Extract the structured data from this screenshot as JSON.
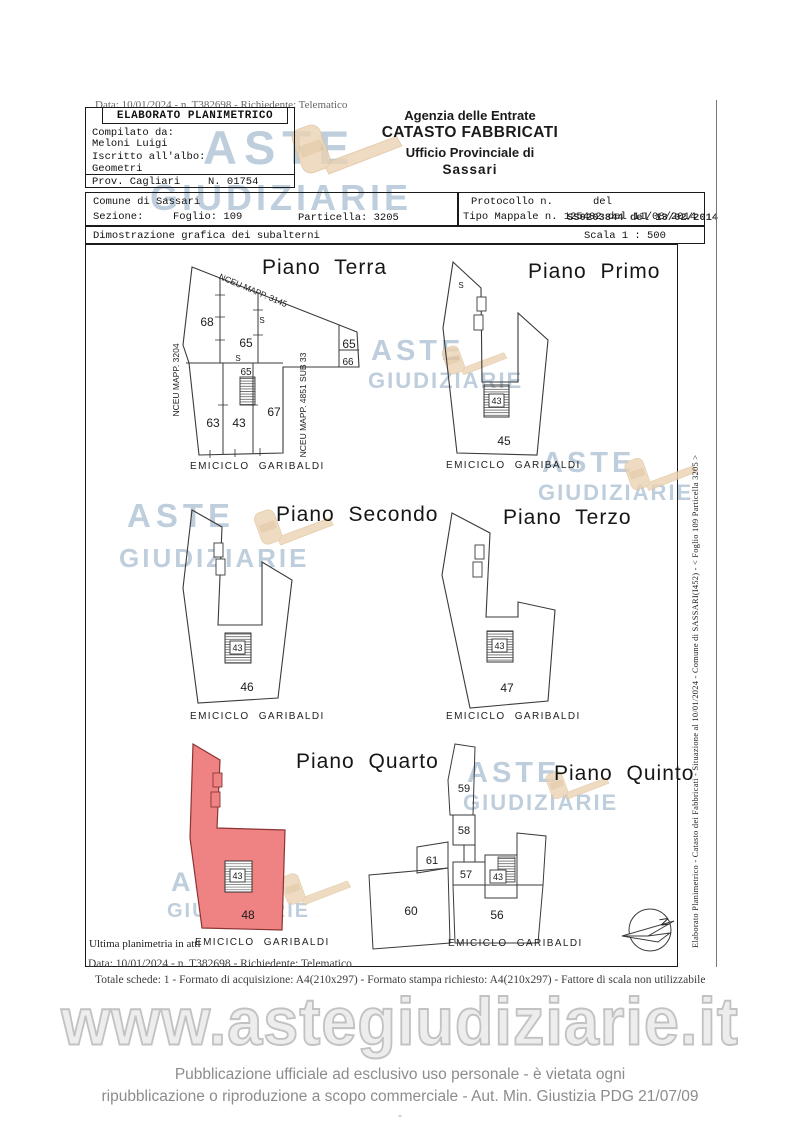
{
  "document": {
    "top_scan_line": "Data: 10/01/2024 - n. T382698 - Richiedente: Telematico",
    "compiler_box": {
      "title": "ELABORATO PLANIMETRICO",
      "compilato_label": "Compilato da:",
      "compilato_value": "Meloni Luigi",
      "iscritto_label": "Iscritto all'albo:",
      "iscritto_value": "Geometri",
      "prov": "Prov. Cagliari",
      "albo_number": "N. 01754"
    },
    "agency": {
      "line1": "Agenzia delle Entrate",
      "line2": "CATASTO FABBRICATI",
      "line3": "Ufficio Provinciale di",
      "line4": "Sassari"
    },
    "location_box": {
      "comune": "Comune di Sassari",
      "sezione_label": "Sezione:",
      "foglio": "Foglio: 109",
      "particella": "Particella: 3205"
    },
    "protocol_box": {
      "protocollo_label": "Protocollo n.",
      "del_label": "del",
      "tipo_mappale": "Tipo Mappale n. 125402 del 11/08/2014",
      "stamp_overlay": "SS0203844 del 13/02/2014"
    },
    "subtitle": "Dimostrazione grafica dei subalterni",
    "scala": "Scala 1 : 500",
    "footer": {
      "data_line": "Data: 10/01/2024 - n. T382698 - Richiedente: Telematico",
      "totale_line": "Totale schede: 1 - Formato di acquisizione: A4(210x297)  - Formato stampa richiesto: A4(210x297) - Fattore di scala non utilizzabile"
    },
    "side_text": "Elaborato Planimetrico - Catasto dei Fabbricati - Situazione al 10/01/2024 - Comune di SASSARI(I452) - < Foglio 109 Particella 3205 >"
  },
  "plans": [
    {
      "title": "Piano Terra",
      "street": "EMICICLO  GARIBALDI",
      "boundaries": {
        "left": "NCEU MAPP. 3204",
        "top": "NCEU MAPP. 3145",
        "right": "NCEU MAPP. 4851 SUB 33"
      },
      "rooms": {
        "r68": "68",
        "r65a": "65",
        "r65b": "65",
        "r66": "66",
        "s1": "S",
        "s2": "S",
        "r65c": "65",
        "r63": "63",
        "r43": "43",
        "r67": "67"
      }
    },
    {
      "title": "Piano Primo",
      "street": "EMICICLO  GARIBALDI",
      "rooms": {
        "s": "S",
        "stair": "43",
        "main": "45"
      }
    },
    {
      "title": "Piano Secondo",
      "street": "EMICICLO  GARIBALDI",
      "rooms": {
        "stair": "43",
        "main": "46"
      }
    },
    {
      "title": "Piano Terzo",
      "street": "EMICICLO  GARIBALDI",
      "rooms": {
        "stair": "43",
        "main": "47"
      }
    },
    {
      "title": "Piano Quarto",
      "street": "EMICICLO  GARIBALDI",
      "note": "Ultima planimetria in atti",
      "rooms": {
        "stair": "43",
        "main": "48"
      }
    },
    {
      "title": "Piano Quinto",
      "street": "EMICICLO  GARIBALDI",
      "rooms": {
        "r59": "59",
        "r58": "58",
        "r61": "61",
        "r57": "57",
        "stair": "43",
        "r60": "60",
        "r56": "56"
      }
    }
  ],
  "watermark": {
    "word1": "ASTE",
    "word2": "GIUDIZIARIE",
    "url": "www.astegiudiziarie.it"
  },
  "disclaimer": {
    "line1": "Pubblicazione ufficiale ad esclusivo uso personale - è vietata ogni",
    "line2": "ripubblicazione o riproduzione a scopo commerciale - Aut. Min. Giustizia PDG 21/07/09",
    "dash": "-"
  },
  "compass_label": "N",
  "colors": {
    "highlight": "#ef8383",
    "watermark_text": "#96b0c7",
    "watermark_gavel": "#ecd3b4"
  }
}
